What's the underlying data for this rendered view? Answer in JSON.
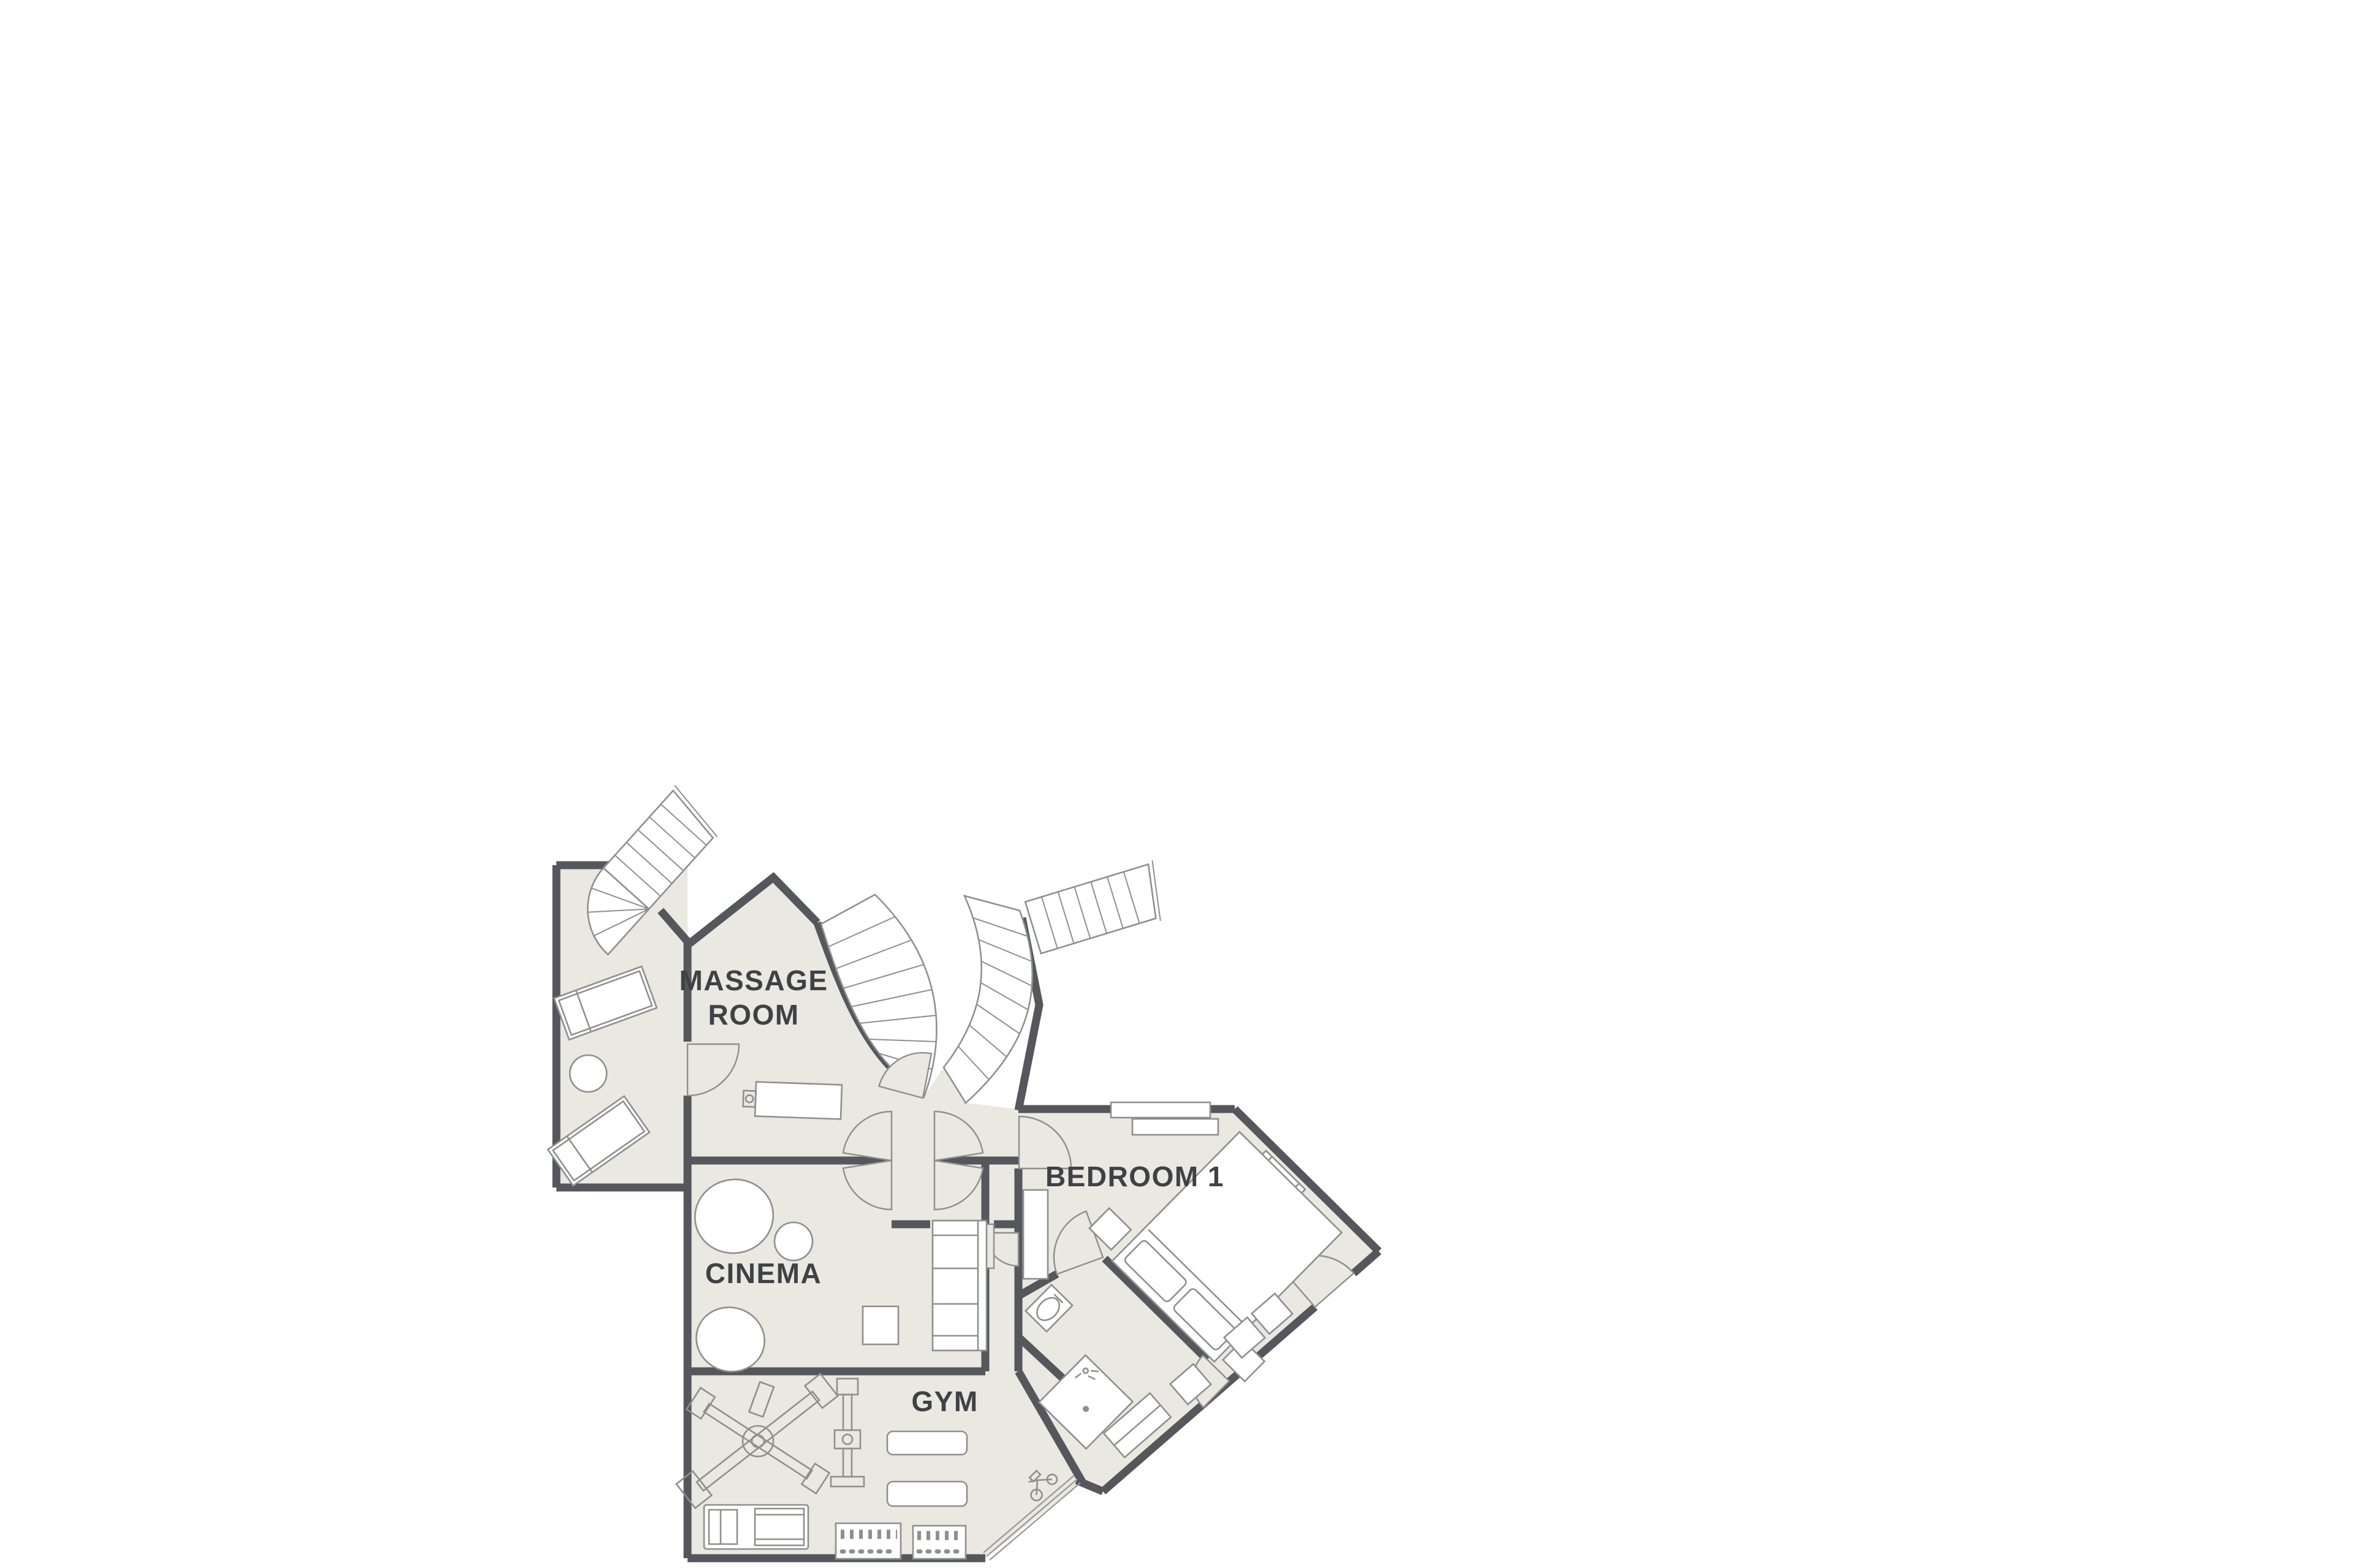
{
  "colors": {
    "background": "#ffffff",
    "floor": "#e9e8e1",
    "wall": "#54575b",
    "furniture_line": "#8d908d",
    "glazing": "#9a9d9a",
    "label_text": "#3f4245"
  },
  "labels": {
    "massage_line1": "MASSAGE",
    "massage_line2": "ROOM",
    "cinema": "CINEMA",
    "gym": "GYM",
    "bedroom": "BEDROOM 1"
  }
}
